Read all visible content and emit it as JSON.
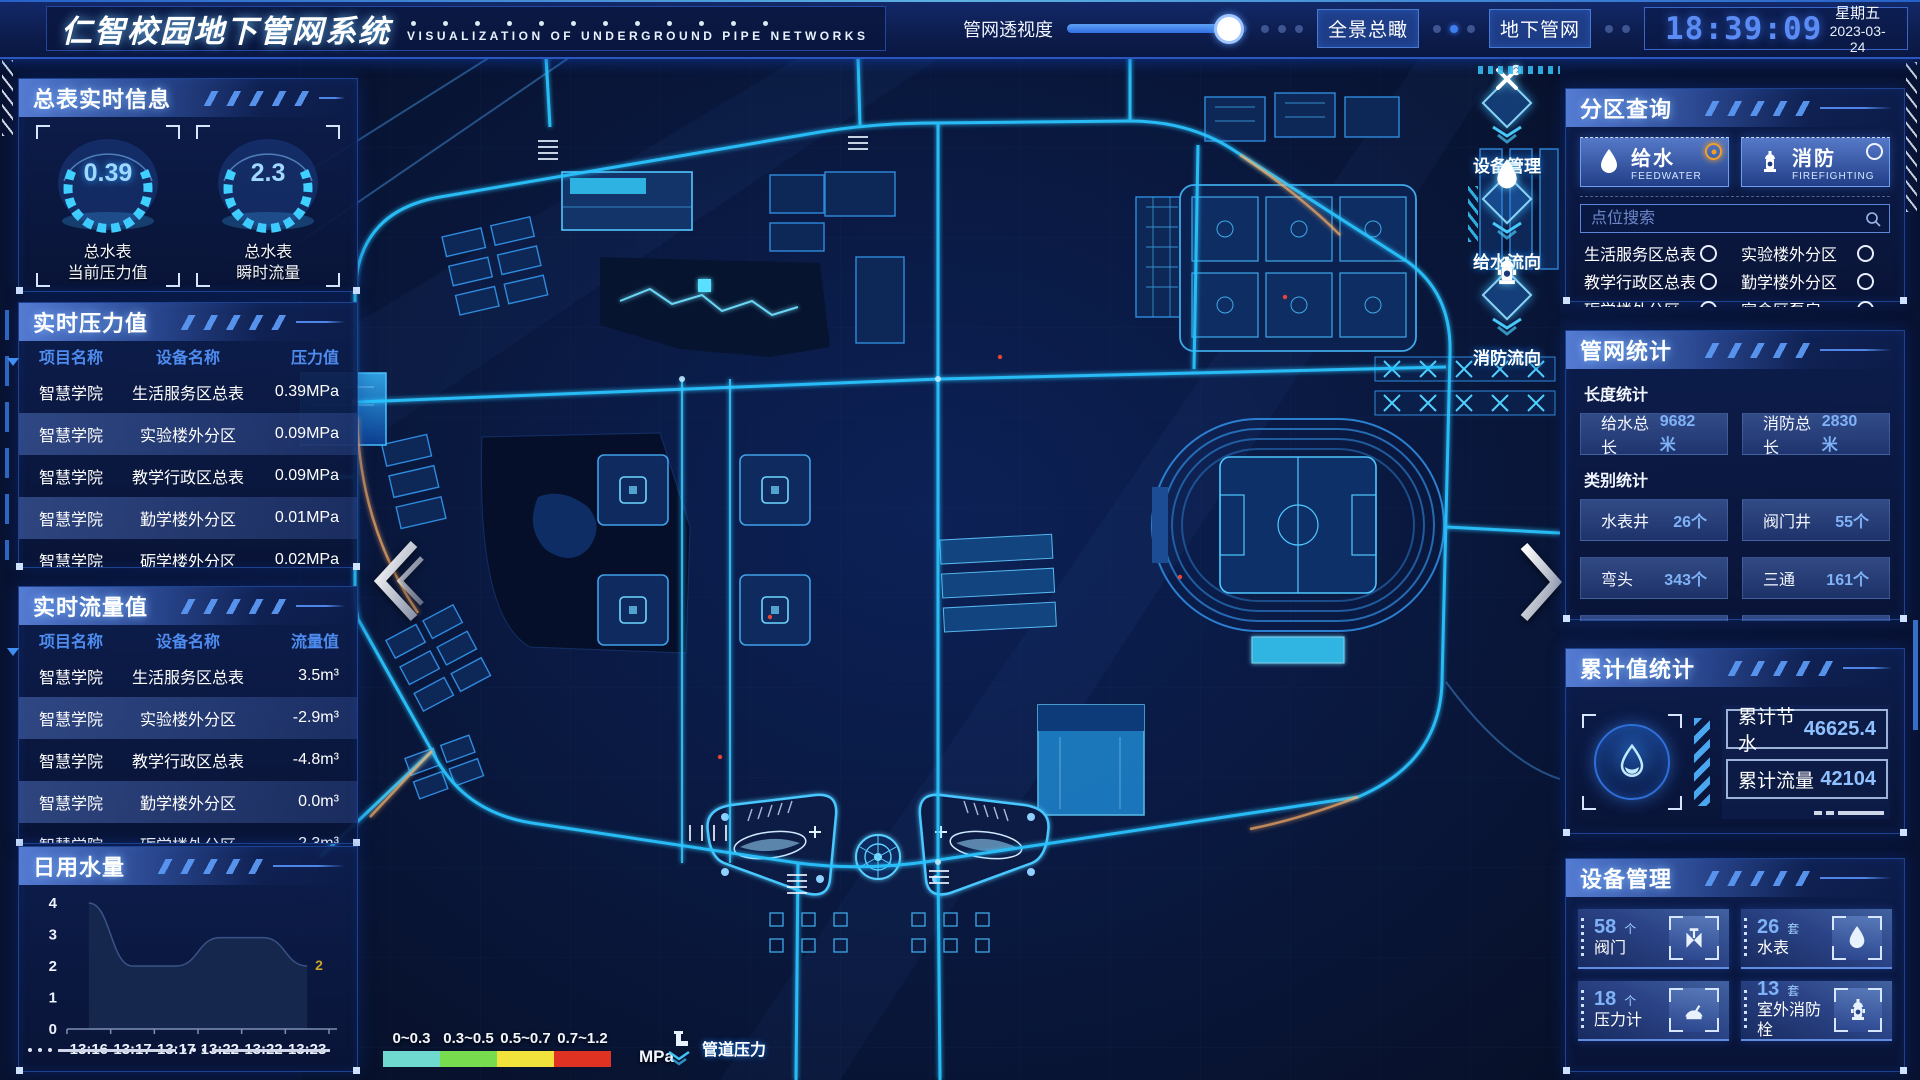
{
  "header": {
    "title": "仁智校园地下管网系统",
    "subtitle": "VISUALIZATION OF UNDERGROUND PIPE NETWORKS",
    "transparency_label": "管网透视度",
    "transparency_percent": 90,
    "overview_btn": "全景总瞰",
    "underground_btn": "地下管网",
    "time": "18:39:09",
    "weekday": "星期五",
    "date": "2023-03-24"
  },
  "meter_info": {
    "title": "总表实时信息",
    "gauges": [
      {
        "value": "0.39",
        "line1": "总水表",
        "line2": "当前压力值"
      },
      {
        "value": "2.3",
        "line1": "总水表",
        "line2": "瞬时流量"
      }
    ]
  },
  "pressure": {
    "title": "实时压力值",
    "headers": [
      "项目名称",
      "设备名称",
      "压力值"
    ],
    "rows": [
      [
        "智慧学院",
        "生活服务区总表",
        "0.39MPa"
      ],
      [
        "智慧学院",
        "实验楼外分区",
        "0.09MPa"
      ],
      [
        "智慧学院",
        "教学行政区总表",
        "0.09MPa"
      ],
      [
        "智慧学院",
        "勤学楼外分区",
        "0.01MPa"
      ],
      [
        "智慧学院",
        "砺学楼外分区",
        "0.02MPa"
      ]
    ]
  },
  "flow": {
    "title": "实时流量值",
    "headers": [
      "项目名称",
      "设备名称",
      "流量值"
    ],
    "rows": [
      [
        "智慧学院",
        "生活服务区总表",
        "3.5m³"
      ],
      [
        "智慧学院",
        "实验楼外分区",
        "-2.9m³"
      ],
      [
        "智慧学院",
        "教学行政区总表",
        "-4.8m³"
      ],
      [
        "智慧学院",
        "勤学楼外分区",
        "0.0m³"
      ],
      [
        "智慧学院",
        "砺学楼外分区",
        "-2.3m³"
      ]
    ]
  },
  "daily": {
    "title": "日用水量"
  },
  "chart_data": {
    "type": "area",
    "title": "日用水量",
    "x": [
      "13:16",
      "13:17",
      "13:17",
      "13:22",
      "13:22",
      "13:23"
    ],
    "values": [
      4,
      2,
      2,
      2.9,
      2.9,
      2
    ],
    "yticks": [
      0,
      1,
      2,
      3,
      4
    ],
    "ylim": [
      0,
      4
    ],
    "end_label": "2",
    "end_label_color": "#c9a227",
    "area_color": "#17284f",
    "legend_position": "none",
    "grid": false
  },
  "map": {
    "markers": [
      {
        "icon": "tools-icon",
        "label": "设备管理"
      },
      {
        "icon": "water-drop-icon",
        "label": "给水流向"
      },
      {
        "icon": "hydrant-icon",
        "label": "消防流向"
      }
    ],
    "legend": {
      "ranges": [
        {
          "label": "0~0.3",
          "color": "#6fd8cf"
        },
        {
          "label": "0.3~0.5",
          "color": "#77dd4e"
        },
        {
          "label": "0.5~0.7",
          "color": "#f2e33c"
        },
        {
          "label": "0.7~1.2",
          "color": "#e03222"
        }
      ],
      "unit": "MPa",
      "pipe_label": "管道压力"
    }
  },
  "zone": {
    "title": "分区查询",
    "tabs": [
      {
        "label": "给水",
        "sub": "FEEDWATER",
        "selected": true
      },
      {
        "label": "消防",
        "sub": "FIREFIGHTING",
        "selected": false
      }
    ],
    "search_placeholder": "点位搜索",
    "points": [
      "生活服务区总表",
      "实验楼外分区",
      "教学行政区总表",
      "勤学楼外分区",
      "砺学楼外分区",
      "宿舍区泵房"
    ]
  },
  "netstats": {
    "title": "管网统计",
    "length_label": "长度统计",
    "length_items": [
      {
        "label": "给水总长",
        "value": "9682米"
      },
      {
        "label": "消防总长",
        "value": "2830米"
      }
    ],
    "category_label": "类别统计",
    "category_items": [
      {
        "label": "水表井",
        "value": "26个"
      },
      {
        "label": "阀门井",
        "value": "55个"
      },
      {
        "label": "弯头",
        "value": "343个"
      },
      {
        "label": "三通",
        "value": "161个"
      }
    ]
  },
  "cumulative": {
    "title": "累计值统计",
    "items": [
      {
        "label": "累计节水",
        "value": "46625.4"
      },
      {
        "label": "累计流量",
        "value": "42104"
      }
    ]
  },
  "devices": {
    "title": "设备管理",
    "cards": [
      {
        "count": "58",
        "unit": "个",
        "label": "阀门",
        "icon": "valve-icon"
      },
      {
        "count": "26",
        "unit": "套",
        "label": "水表",
        "icon": "water-drop-icon"
      },
      {
        "count": "18",
        "unit": "个",
        "label": "压力计",
        "icon": "pressure-gauge-icon"
      },
      {
        "count": "13",
        "unit": "套",
        "label": "室外消防栓",
        "icon": "hydrant-icon"
      }
    ]
  }
}
